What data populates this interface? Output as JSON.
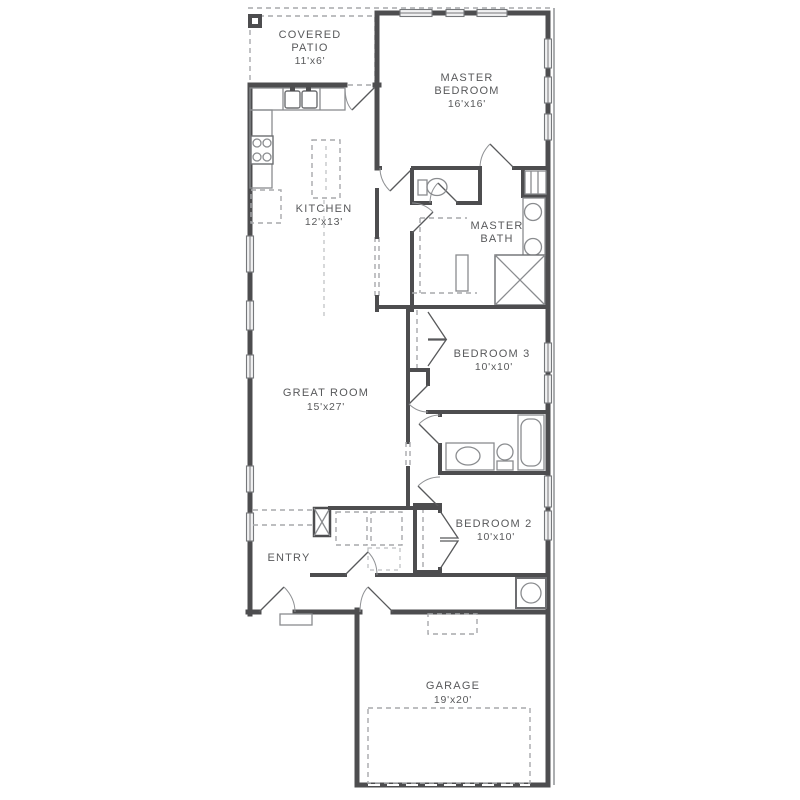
{
  "plan": {
    "type": "residential-floor-plan",
    "rooms": {
      "covered_patio": {
        "name": "COVERED PATIO",
        "dims": "11'x6'",
        "lines": [
          "COVERED",
          "PATIO",
          "11'x6'"
        ]
      },
      "master_bedroom": {
        "name": "MASTER BEDROOM",
        "dims": "16'x16'",
        "lines": [
          "MASTER",
          "BEDROOM",
          "16'x16'"
        ]
      },
      "kitchen": {
        "name": "KITCHEN",
        "dims": "12'x13'",
        "lines": [
          "KITCHEN",
          "12'x13'"
        ]
      },
      "master_bath": {
        "name": "MASTER BATH",
        "lines": [
          "MASTER",
          "BATH"
        ]
      },
      "great_room": {
        "name": "GREAT ROOM",
        "dims": "15'x27'",
        "lines": [
          "GREAT ROOM",
          "15'x27'"
        ]
      },
      "bedroom_3": {
        "name": "BEDROOM 3",
        "dims": "10'x10'",
        "lines": [
          "BEDROOM 3",
          "10'x10'"
        ]
      },
      "bedroom_2": {
        "name": "BEDROOM 2",
        "dims": "10'x10'",
        "lines": [
          "BEDROOM 2",
          "10'x10'"
        ]
      },
      "entry": {
        "name": "ENTRY",
        "lines": [
          "ENTRY"
        ]
      },
      "garage": {
        "name": "GARAGE",
        "dims": "19'x20'",
        "lines": [
          "GARAGE",
          "19'x20'"
        ]
      }
    },
    "fixtures": [
      "kitchen-sink",
      "range",
      "kitchen-island",
      "toilet",
      "tub",
      "shower",
      "double-vanity",
      "vanity",
      "washer-dryer",
      "water-heater",
      "linen-shelves",
      "entry-closet",
      "attic-access",
      "garage-door",
      "front-door",
      "windows",
      "walk-in-closet"
    ],
    "colors": {
      "wall": "#4d4d4f",
      "fixture": "#8a8c8f",
      "dashed": "#a7a9ac",
      "text": "#58595b",
      "window_fill": "#f1f1f2",
      "background": "#ffffff"
    }
  }
}
